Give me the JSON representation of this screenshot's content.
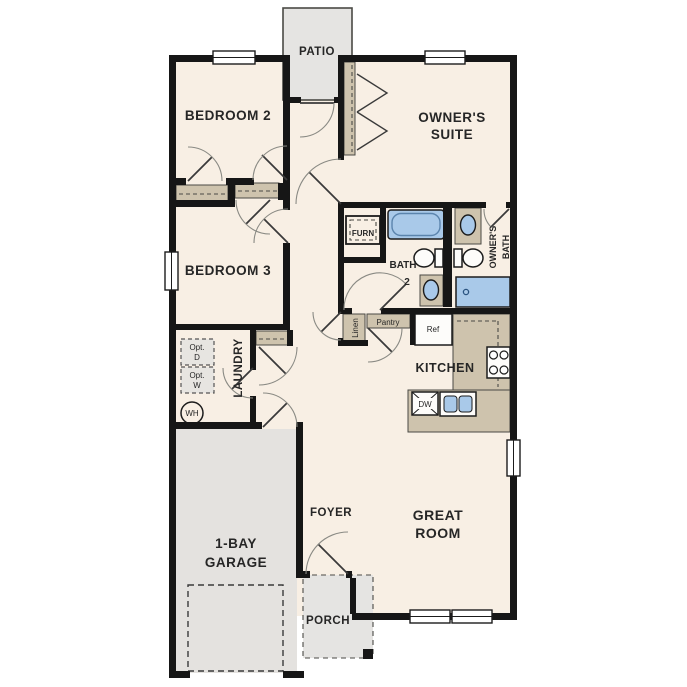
{
  "title": "single-story house floor plan",
  "palette": {
    "interior_floor": "#f8efe4",
    "walls": "#161616",
    "casework_tan": "#cec3ad",
    "plumbing_blue": "#a9c9e9",
    "exterior_concrete": "#e5e4e2",
    "label_text": "#262626"
  },
  "rooms": {
    "patio": {
      "label": "PATIO"
    },
    "bedroom2": {
      "label": "BEDROOM 2"
    },
    "owners_suite": {
      "line1": "OWNER'S",
      "line2": "SUITE"
    },
    "bedroom3": {
      "label": "BEDROOM 3"
    },
    "bath2": {
      "line1": "BATH",
      "line2": "2"
    },
    "owners_bath": {
      "line1": "OWNER'S",
      "line2": "BATH"
    },
    "laundry": {
      "label": "LAUNDRY"
    },
    "kitchen": {
      "label": "KITCHEN"
    },
    "foyer": {
      "label": "FOYER"
    },
    "great_room": {
      "line1": "GREAT",
      "line2": "ROOM"
    },
    "garage": {
      "line1": "1-BAY",
      "line2": "GARAGE"
    },
    "porch": {
      "label": "PORCH"
    }
  },
  "fixtures": {
    "furnace": "FURN",
    "linen": "Linen",
    "pantry": "Pantry",
    "refrigerator": "Ref",
    "dishwasher": "DW",
    "water_heater": "WH",
    "optional_dryer": {
      "line1": "Opt.",
      "line2": "D"
    },
    "optional_washer": {
      "line1": "Opt.",
      "line2": "W"
    }
  }
}
